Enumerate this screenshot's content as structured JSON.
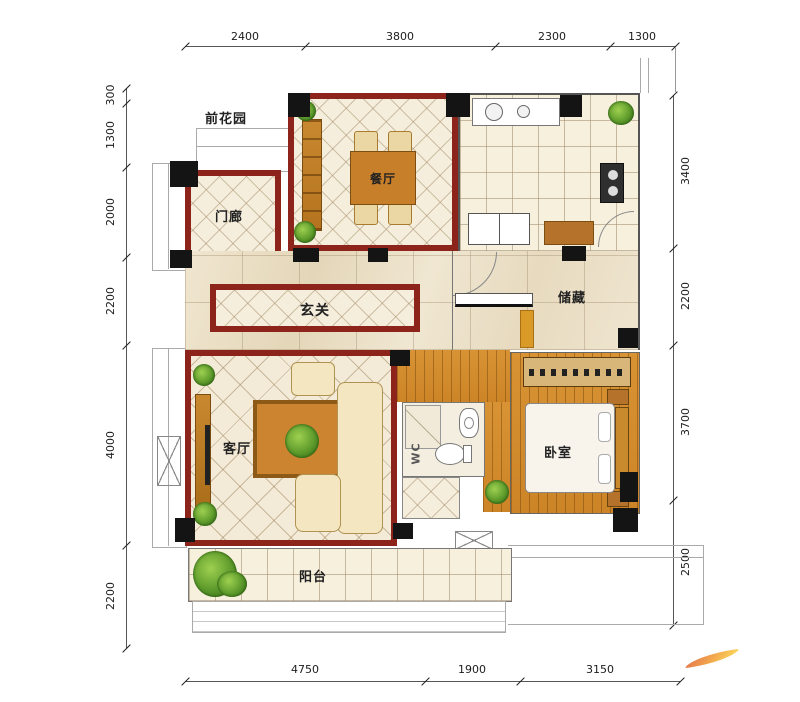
{
  "plan": {
    "garden_front": "前花园",
    "garden_back": "后花园",
    "rooms": {
      "porch": "门廊",
      "dining": "餐厅",
      "kitchen": "厨房",
      "foyer": "玄关",
      "storage": "储藏",
      "living": "客厅",
      "bedroom": "卧室",
      "wc": "WC",
      "balcony": "阳台"
    },
    "dimensions": {
      "top": [
        "2400",
        "3800",
        "2300",
        "1300"
      ],
      "left": [
        "300",
        "1300",
        "2000",
        "2200",
        "4000",
        "2200"
      ],
      "right": [
        "3400",
        "2200",
        "3700",
        "2500"
      ],
      "bottom": [
        "4750",
        "1900",
        "3150"
      ]
    },
    "colors": {
      "wall": "#8c241c",
      "wood_floor": "#d28e35",
      "tile": "#f5eedc",
      "marble": "#ece1cb",
      "column": "#141414",
      "logo": "#f2a23a"
    }
  }
}
